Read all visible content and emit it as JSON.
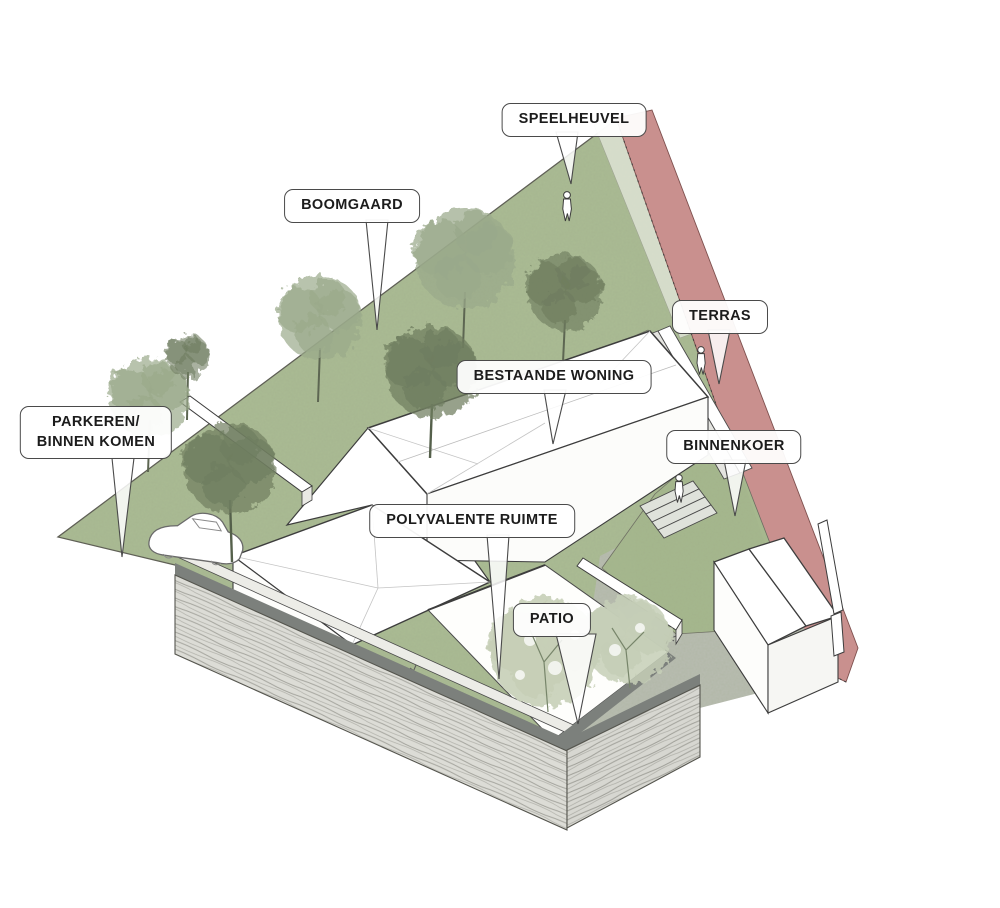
{
  "diagram": {
    "description": "Architectural axonometric site diagram with Dutch program labels",
    "labels": [
      {
        "id": "speelheuvel",
        "text": "SPEELHEUVEL"
      },
      {
        "id": "boomgaard",
        "text": "BOOMGAARD"
      },
      {
        "id": "terras",
        "text": "TERRAS"
      },
      {
        "id": "bestaande-woning",
        "text": "BESTAANDE WONING"
      },
      {
        "id": "parkeren",
        "line1": "PARKEREN/",
        "line2": "BINNEN KOMEN"
      },
      {
        "id": "binnenkoer",
        "text": "BINNENKOER"
      },
      {
        "id": "polyvalente-ruimte",
        "text": "POLYVALENTE RUIMTE"
      },
      {
        "id": "patio",
        "text": "PATIO"
      }
    ],
    "colors": {
      "grass": "#abbc94",
      "grass2": "#a6b88e",
      "accent": "#c9908e",
      "path": "#b9bdb2",
      "cap": "#7c807c",
      "brickface": "#dcdcd6",
      "outline": "#3d3d3d",
      "treeDark": "#6f7d60",
      "treeLight": "#9aa98a",
      "patioTree": "#c6cfb7"
    }
  }
}
